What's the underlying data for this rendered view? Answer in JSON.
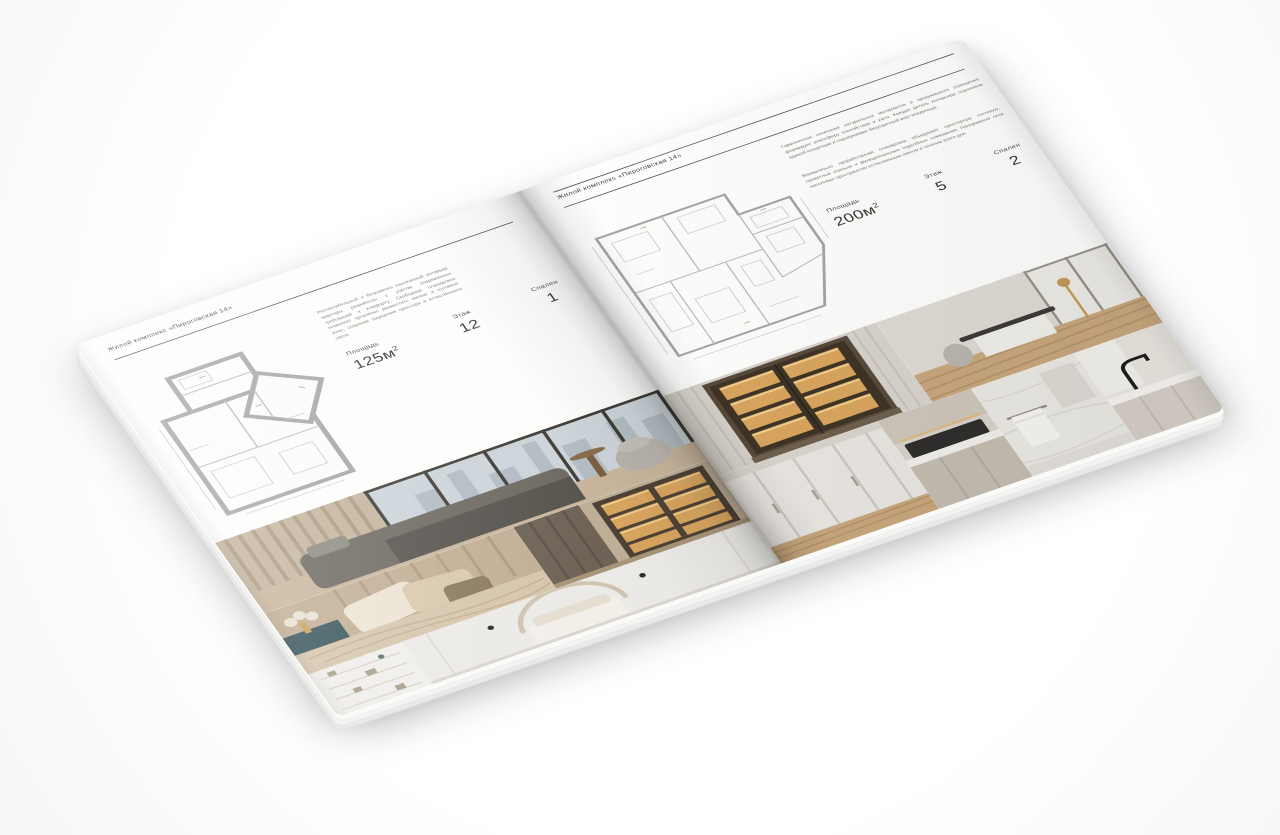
{
  "book": {
    "left_page": {
      "header": "Жилой комплекс «Пироговская 14»",
      "description": "Респектабельный и безупречно изысканный интерьер квартиры разработан с учётом современных требований к комфорту. Свободная планировка позволяет органично разместить жилые и гостевые зоны, сохранив ощущение простора и естественного света.",
      "specs": [
        {
          "label": "Площадь",
          "value": "125м",
          "sup": "2"
        },
        {
          "label": "Этаж",
          "value": "12",
          "sup": ""
        },
        {
          "label": "Спален",
          "value": "1",
          "sup": ""
        }
      ]
    },
    "right_page": {
      "header": "Жилой комплекс «Пироговская 14»",
      "description_1": "Гармоничное сочетание натуральных материалов и продуманного освещения формирует атмосферу спокойствия и уюта. Каждая деталь интерьера подчинена единой концепции и подчёркивает безупречный вкус владельца.",
      "description_2": "Внимательно проработанная планировка объединяет просторную гостиную, приватные спальни и функциональные подсобные помещения. Панорамные окна наполняют пространство естественным светом в течение всего дня.",
      "specs": [
        {
          "label": "Площадь",
          "value": "200м",
          "sup": "2"
        },
        {
          "label": "Этаж",
          "value": "5",
          "sup": ""
        },
        {
          "label": "Спален",
          "value": "2",
          "sup": ""
        }
      ]
    }
  }
}
